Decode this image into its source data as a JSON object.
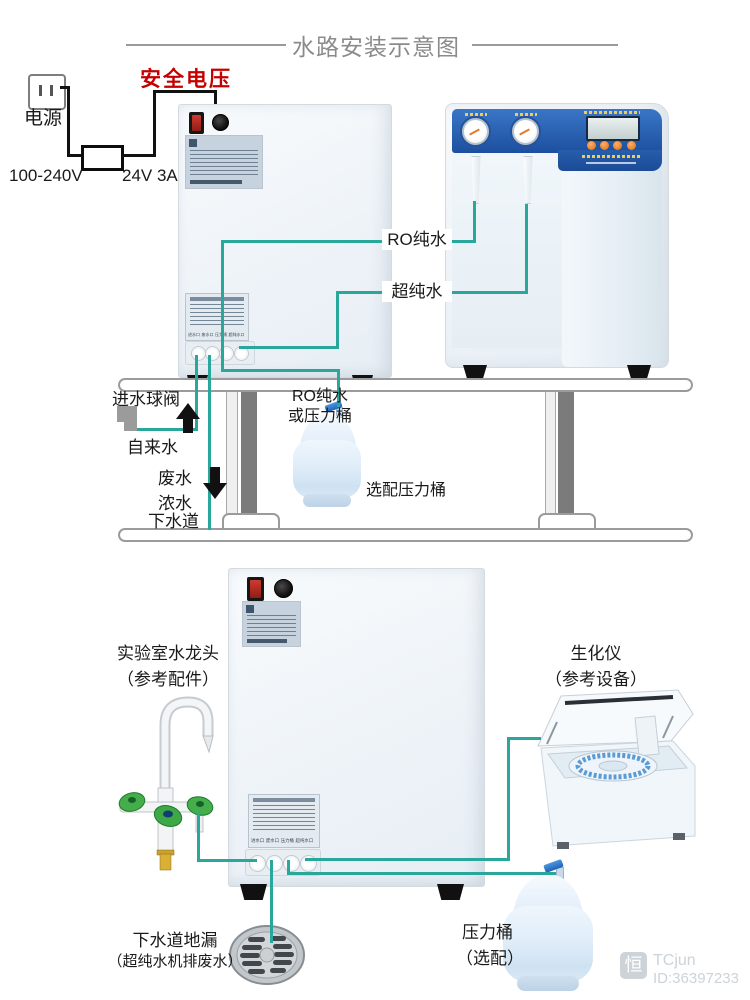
{
  "header": {
    "title": "水路安装示意图"
  },
  "power": {
    "source_label": "电源",
    "safe_voltage_label": "安全电压",
    "input_rating": "100-240V",
    "output_rating": "24V 3A"
  },
  "top_diagram": {
    "ro_water": "RO纯水",
    "ultrapure_water": "超纯水",
    "inlet_ball_valve": "进水球阀",
    "tap_water": "自来水",
    "waste_water": "废水",
    "concentrated_water": "浓水",
    "sewer": "下水道",
    "ro_or_tank_line1": "RO纯水",
    "ro_or_tank_line2": "或压力桶",
    "optional_tank": "选配压力桶"
  },
  "bottom_diagram": {
    "faucet_title": "实验室水龙头",
    "faucet_note": "（参考配件）",
    "analyzer_title": "生化仪",
    "analyzer_note": "（参考设备）",
    "drain_title": "下水道地漏",
    "drain_note": "（超纯水机排废水）",
    "tank_title": "压力桶",
    "tank_note": "（选配）"
  },
  "machine_ports": {
    "inlet": "进水口",
    "waste": "废水口",
    "tank": "压力桶",
    "ultrapure": "超纯水口"
  },
  "watermark": {
    "logo_char": "恒",
    "name": "TCjun",
    "id": "ID:36397233"
  },
  "colors": {
    "pipe_teal": "#2aa79b",
    "warning_red": "#c40000",
    "panel_blue": "#2a62b8",
    "wire_black": "#111111"
  }
}
